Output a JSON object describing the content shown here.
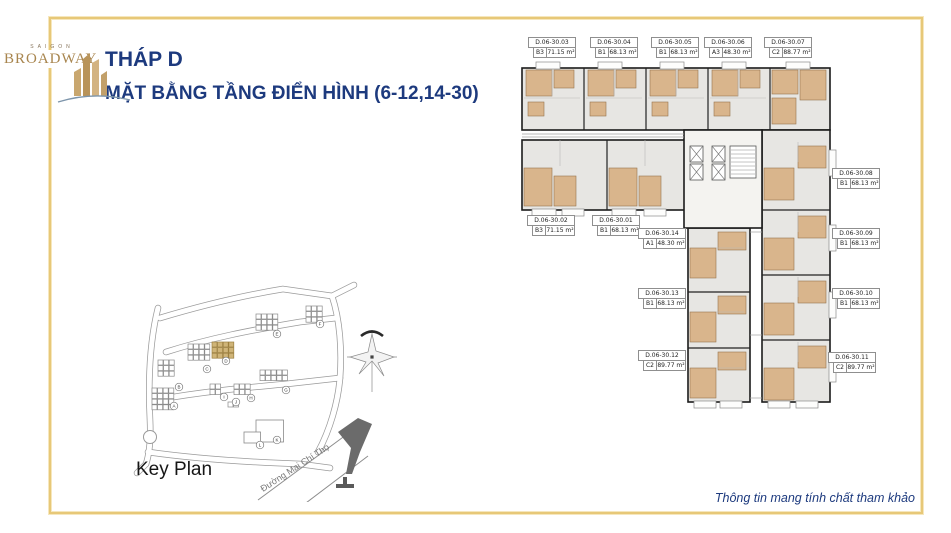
{
  "logo": {
    "brand_top": "SAIGON",
    "brand_bottom": "BROADWAY"
  },
  "header": {
    "title": "THÁP D",
    "subtitle": "MẶT BẰNG TẦNG ĐIỂN HÌNH (6-12,14-30)"
  },
  "key_plan": {
    "label": "Key Plan",
    "street": "Đường Mai Chí Thọ",
    "blocks": [
      "A",
      "B",
      "C",
      "D",
      "E",
      "F",
      "G",
      "H",
      "I",
      "J",
      "K",
      "L"
    ],
    "highlighted_block": "D"
  },
  "floor_plan": {
    "tower": "D",
    "floors": "6-12,14-30",
    "units": [
      {
        "code": "D.06-30.03",
        "type": "B3",
        "area": "71.15 m²"
      },
      {
        "code": "D.06-30.04",
        "type": "B1",
        "area": "68.13 m²"
      },
      {
        "code": "D.06-30.05",
        "type": "B1",
        "area": "68.13 m²"
      },
      {
        "code": "D.06-30.06",
        "type": "A3",
        "area": "48.30 m²"
      },
      {
        "code": "D.06-30.07",
        "type": "C2",
        "area": "88.77 m²"
      },
      {
        "code": "D.06-30.02",
        "type": "B3",
        "area": "71.15 m²"
      },
      {
        "code": "D.06-30.01",
        "type": "B1",
        "area": "68.13 m²"
      },
      {
        "code": "D.06-30.14",
        "type": "A1",
        "area": "48.30 m²"
      },
      {
        "code": "D.06-30.13",
        "type": "B1",
        "area": "68.13 m²"
      },
      {
        "code": "D.06-30.12",
        "type": "C2",
        "area": "89.77 m²"
      },
      {
        "code": "D.06-30.08",
        "type": "B1",
        "area": "68.13 m²"
      },
      {
        "code": "D.06-30.09",
        "type": "B1",
        "area": "68.13 m²"
      },
      {
        "code": "D.06-30.10",
        "type": "B1",
        "area": "68.13 m²"
      },
      {
        "code": "D.06-30.11",
        "type": "C2",
        "area": "89.77 m²"
      }
    ]
  },
  "footer": {
    "disclaimer": "Thông tin mang tính chất tham khảo"
  },
  "colors": {
    "accent_navy": "#1d3a7e",
    "frame_gold": "#e7c878",
    "logo_gold": "#a8854e",
    "room_tan": "#d9b58c",
    "plan_floor_gray": "#e7e6e3",
    "highlight_block_gold": "#cfb478"
  }
}
